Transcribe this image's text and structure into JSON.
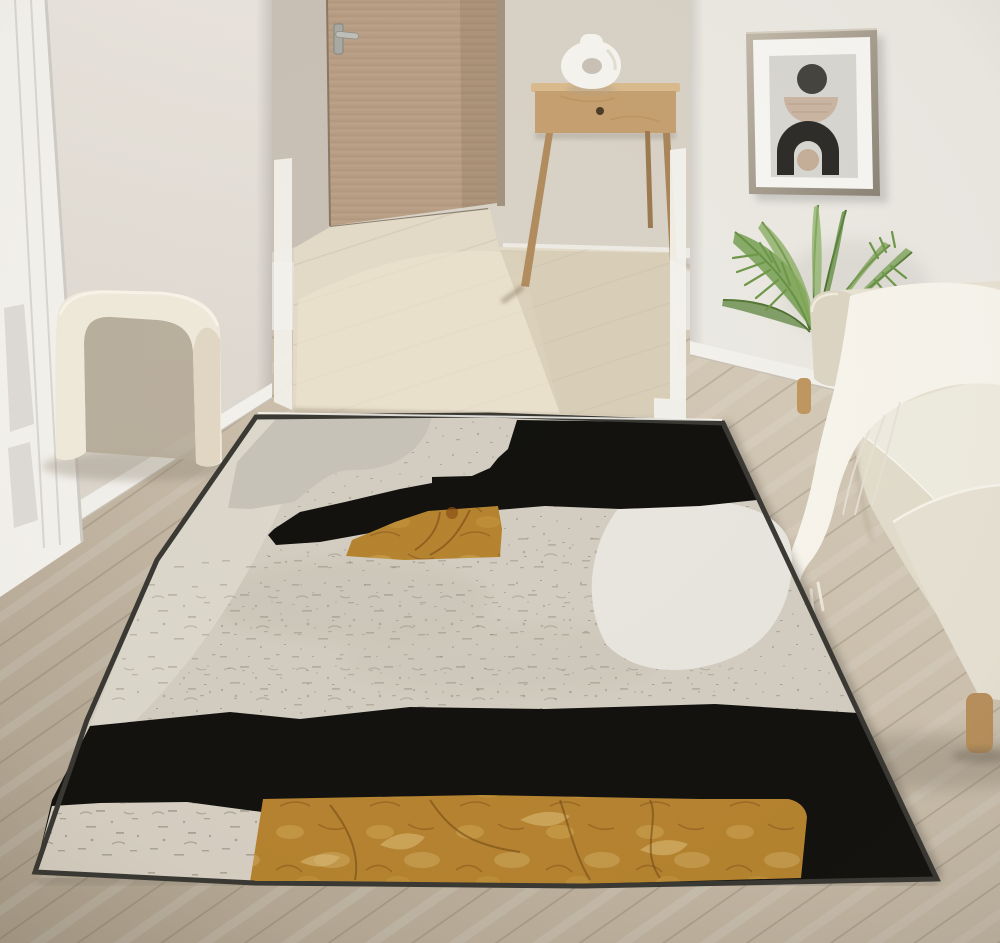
{
  "scene": {
    "type": "interior-photograph",
    "setting": "Bright living room with open hallway, wooden interior door, wooden console table with sculptural vase, framed abstract wall art, areca palm plant, cream boucle sofa with fringed white throw, arched cream ottoman, and a large abstract area rug (beige, black and ochre) laid diagonally on a light oak plank floor"
  },
  "objects": {
    "wooden_door": "wooden interior door with steel handle, seen through hallway opening",
    "console_table": "light wood console table with single drawer and splayed legs",
    "vase": "white sculptural donut-shaped ceramic vase",
    "wall_art": "framed abstract print: dark circle, beige half-disc, black arch with beige circle",
    "plant": "areca palm fronds",
    "sofa": "cream fabric sofa with chaise, wooden legs",
    "throw": "white fringed throw blanket draped over sofa",
    "ottoman": "cream arch-shaped boucle ottoman",
    "rug": "abstract area rug with mottled beige field, sweeping black bands and ochre patches",
    "floor": "light oak plank flooring laid diagonally",
    "left_door": "white paneled door at far left edge"
  },
  "palette": {
    "wall_left": "#e5e0d8",
    "wall_right": "#ebe8e2",
    "wall_back": "#d8d1c5",
    "trim_white": "#f3f1ec",
    "door_wood": "#b79d83",
    "hall_floor": "#e2d9c6",
    "floor_wood": "#c8bcaa",
    "rug_field": "#d3cdc1",
    "rug_black": "#12110e",
    "rug_gold": "#b5832f",
    "rug_gold_light": "#d4aa56",
    "rug_light_strip": "#dcd7cb",
    "rug_gray_blob": "#c7c2b8",
    "rug_white_blob": "#e8e5de",
    "rug_bottom_strip": "#d6cfc2",
    "rug_border": "#3a3833",
    "sofa_cream": "#e7e1d2",
    "sofa_cushion": "#eeebdf",
    "throw_white": "#f7f4ec",
    "stool_cream": "#efe9da",
    "plant_green": "#6e9a49",
    "table_wood": "#c59f6f",
    "vase_white": "#f5f3ee",
    "art_frame": "#a99f90",
    "art_bg": "#d8d6d1",
    "art_black": "#2d2c29",
    "art_beige": "#c9b5a2",
    "leg_wood": "#bf9660"
  }
}
